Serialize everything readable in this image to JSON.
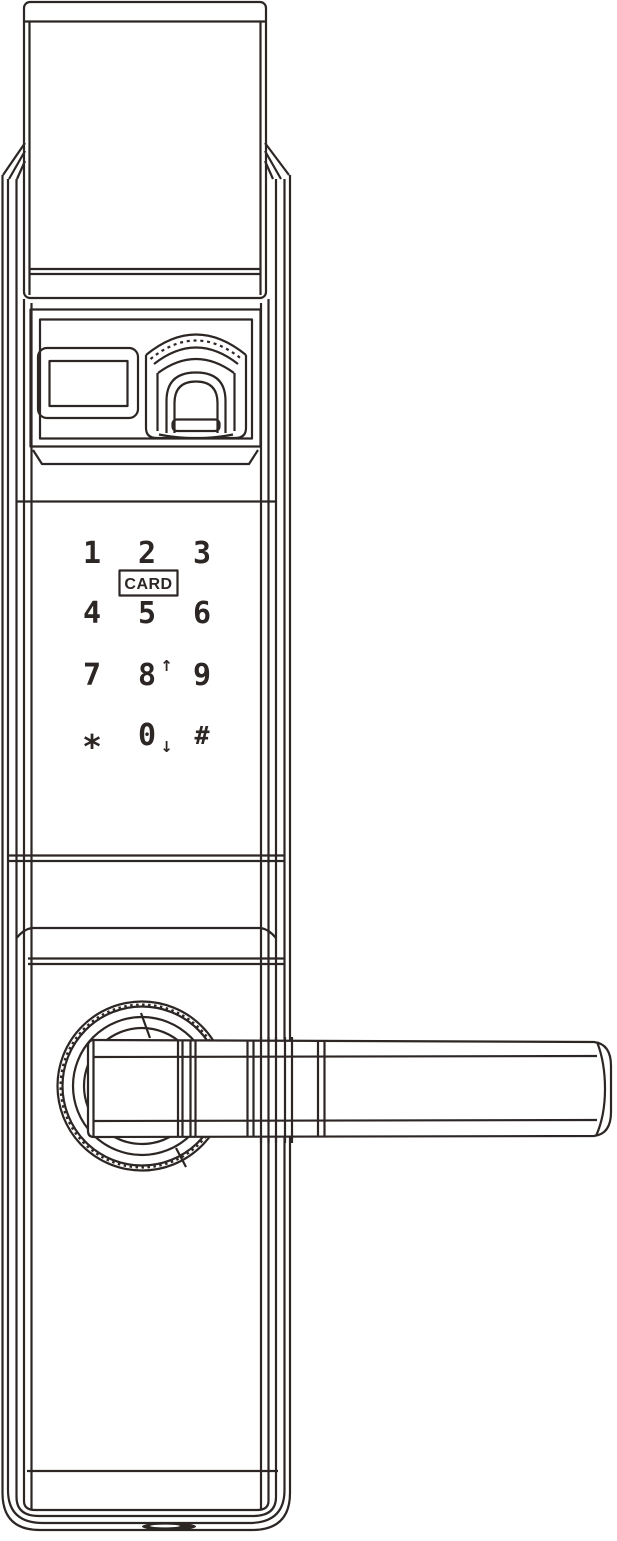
{
  "colors": {
    "ink": "#2c2624",
    "paper": "#ffffff"
  },
  "keypad": {
    "card_label": "CARD",
    "keys": [
      {
        "label": "1"
      },
      {
        "label": "2"
      },
      {
        "label": "3"
      },
      {
        "label": "4"
      },
      {
        "label": "5"
      },
      {
        "label": "6"
      },
      {
        "label": "7"
      },
      {
        "label": "8",
        "suffix": "↑"
      },
      {
        "label": "9"
      },
      {
        "label": "*"
      },
      {
        "label": "0",
        "suffix": "↓"
      },
      {
        "label": "#"
      }
    ]
  }
}
